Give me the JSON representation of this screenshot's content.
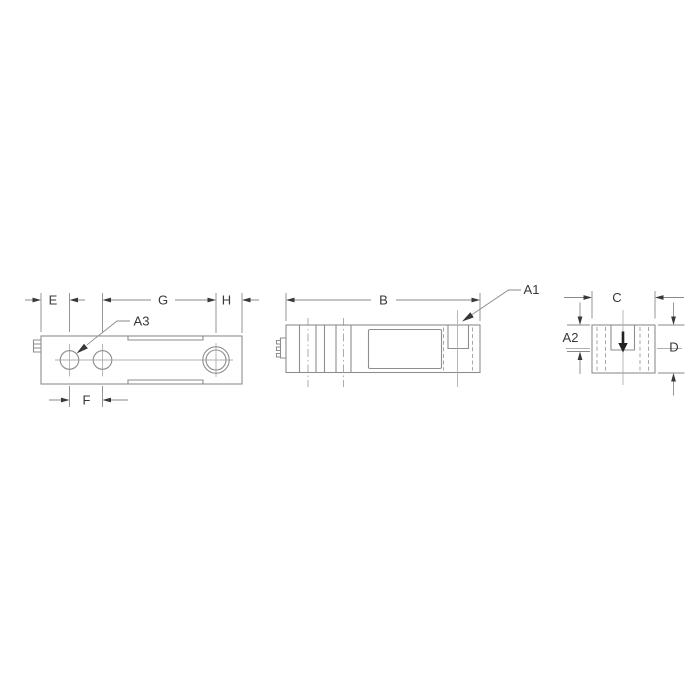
{
  "colors": {
    "outline": "#8e8e8e",
    "thin": "#b0b0b0",
    "hidden": "#a3a3a3",
    "dim": "#8a8a8a",
    "ink": "#383838",
    "load": "#222222",
    "background": "#ffffff"
  },
  "drawing": {
    "top_view": {
      "labels": {
        "e": "E",
        "g": "G",
        "h": "H",
        "f": "F",
        "a3": "A3"
      }
    },
    "side_view": {
      "labels": {
        "b": "B",
        "a1": "A1"
      }
    },
    "end_view": {
      "labels": {
        "c": "C",
        "a2": "A2",
        "d": "D"
      }
    }
  }
}
